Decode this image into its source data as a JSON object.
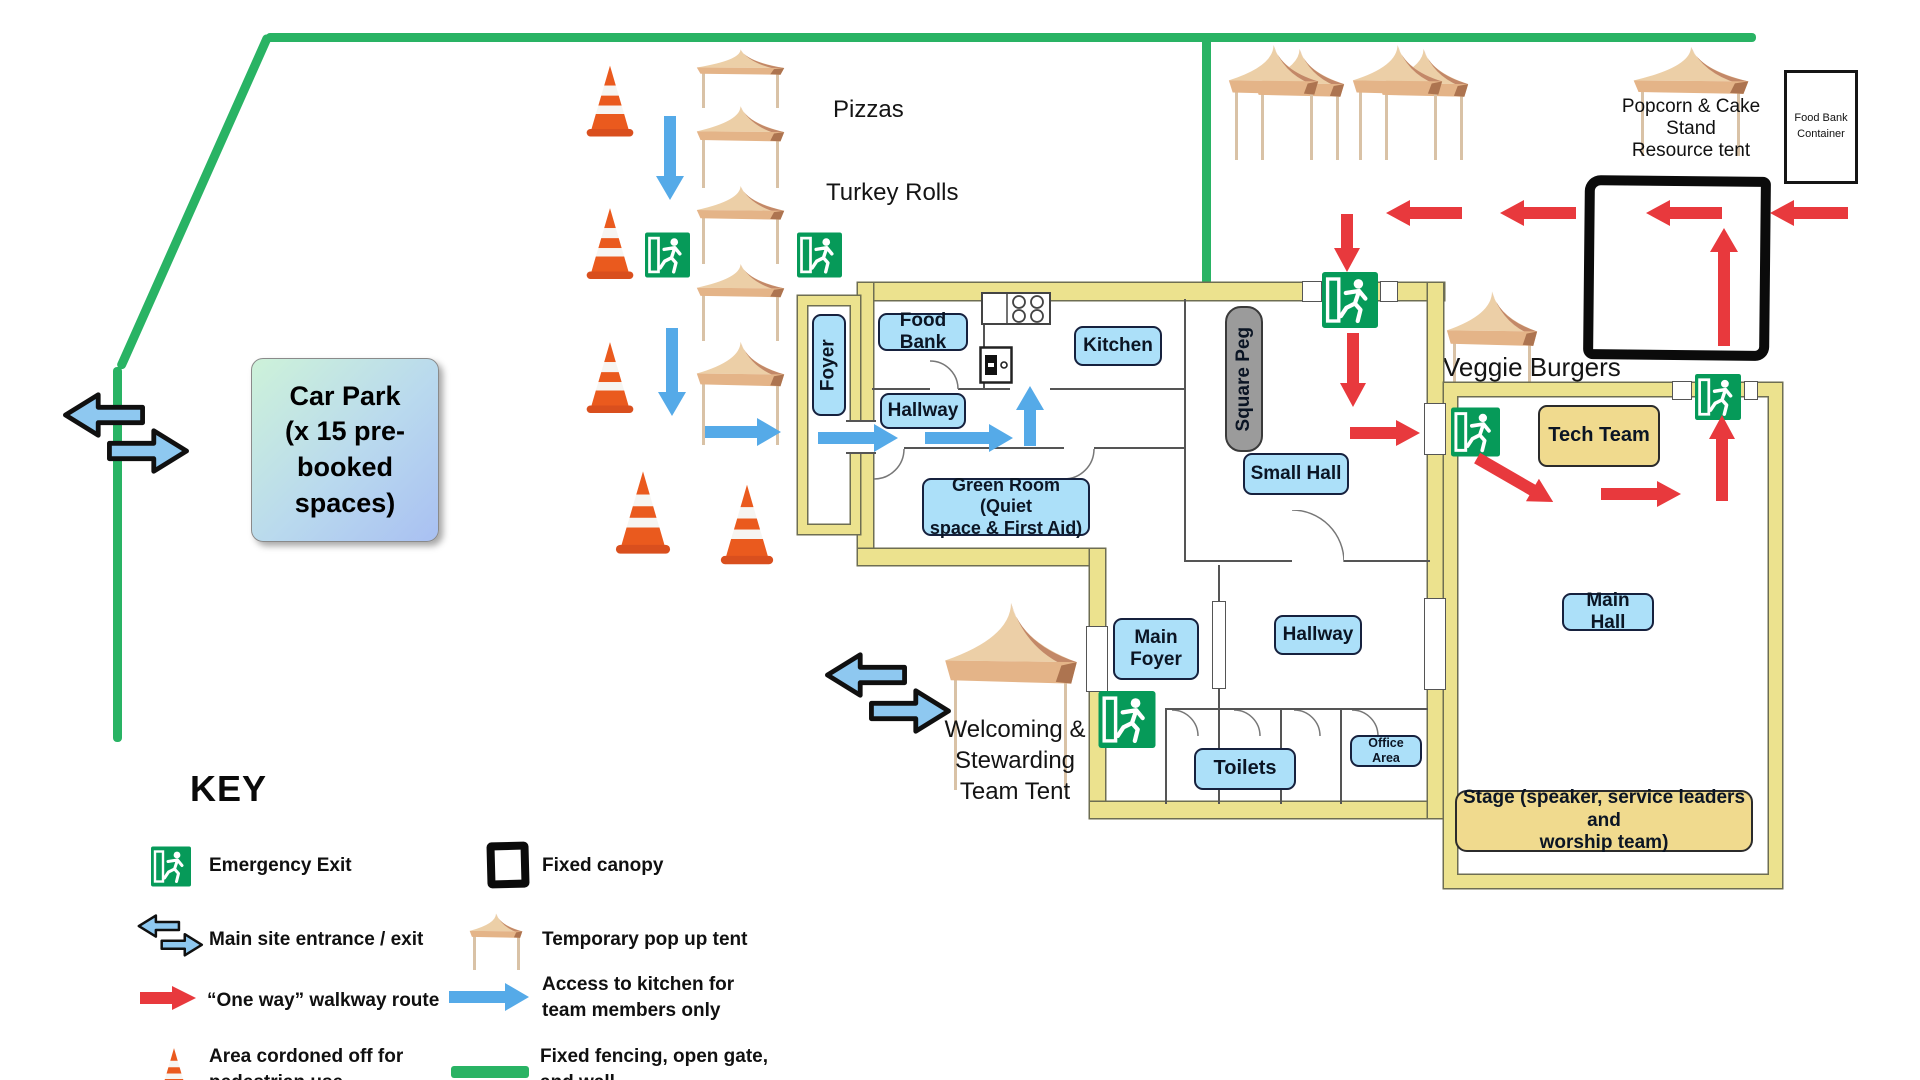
{
  "car_park": {
    "line1": "Car Park",
    "line2": "(x 15 pre-",
    "line3": "booked",
    "line4": "spaces)"
  },
  "rooms": {
    "food_bank": "Food Bank",
    "kitchen": "Kitchen",
    "hallway_top": "Hallway",
    "foyer": "Foyer",
    "green_room_1": "Green Room (Quiet",
    "green_room_2": "space & First Aid)",
    "square_peg": "Square Peg",
    "small_hall": "Small Hall",
    "main_foyer_1": "Main",
    "main_foyer_2": "Foyer",
    "hallway_bottom": "Hallway",
    "toilets": "Toilets",
    "office_area": "Office Area",
    "tech_team": "Tech Team",
    "main_hall": "Main Hall",
    "stage_1": "Stage (speaker, service leaders and",
    "stage_2": "worship team)"
  },
  "stands": {
    "pizzas": "Pizzas",
    "turkey_rolls": "Turkey Rolls",
    "veggie_burgers": "Veggie Burgers",
    "popcorn_1": "Popcorn &  Cake",
    "popcorn_2": "Stand",
    "popcorn_3": "Resource tent",
    "container_1": "Food Bank",
    "container_2": "Container",
    "welcoming_1": "Welcoming &",
    "welcoming_2": "Stewarding",
    "welcoming_3": "Team Tent"
  },
  "key": {
    "title": "KEY",
    "emergency_exit": "Emergency Exit",
    "main_entrance": "Main site entrance / exit",
    "one_way": "“One way” walkway route",
    "cordoned_1": "Area cordoned off for",
    "cordoned_2": "pedestrian use",
    "fixed_canopy": "Fixed canopy",
    "pop_up_tent": "Temporary pop up tent",
    "kitchen_access_1": "Access to kitchen for",
    "kitchen_access_2": "team members only",
    "fencing_1": "Fixed fencing, open gate,",
    "fencing_2": "and wall"
  },
  "colors": {
    "fence_green": "#29b364",
    "one_way_red": "#e8393d",
    "kitchen_access_blue": "#55aae8",
    "exit_green": "#069a59",
    "wall_yellow": "#ece28e",
    "room_label_blue": "#ace0f9",
    "stage_yellow": "#f0da8e",
    "cone_orange": "#ea5a1e",
    "entrance_blue": "#8ec8f0"
  },
  "icons": {
    "emergency_exit": "exit-running-man-icon",
    "main_entrance": "double-block-arrows-icon",
    "one_way": "red-arrow-icon",
    "cordoned": "traffic-cone-icon",
    "fixed_canopy": "black-square-icon",
    "pop_up_tent": "tent-icon",
    "kitchen_access": "blue-arrow-icon",
    "fencing": "green-line-icon"
  }
}
